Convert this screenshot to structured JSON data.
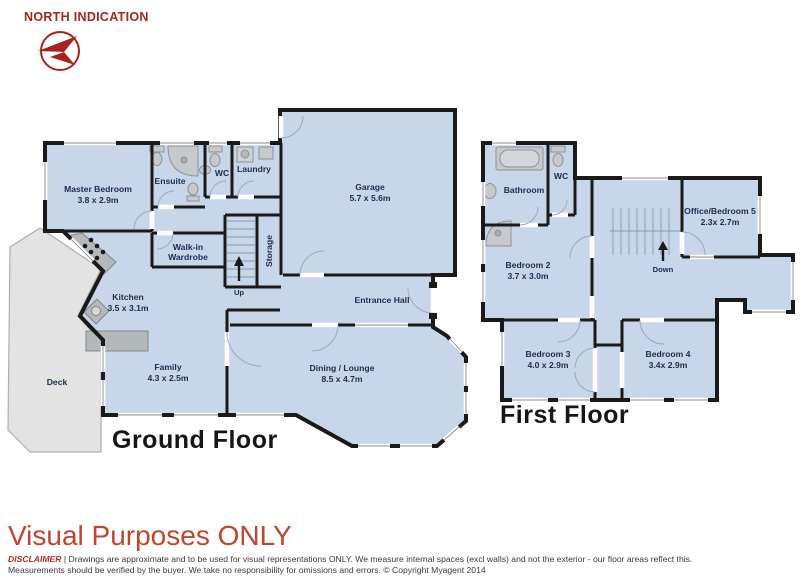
{
  "north": {
    "label": "NORTH INDICATION"
  },
  "floors": {
    "ground": {
      "title": "Ground Floor",
      "rooms": {
        "master": {
          "name": "Master Bedroom",
          "dims": "3.8 x 2.9m"
        },
        "ensuite": {
          "name": "Ensuite"
        },
        "wc": {
          "name": "WC"
        },
        "laundry": {
          "name": "Laundry"
        },
        "garage": {
          "name": "Garage",
          "dims": "5.7 x 5.6m"
        },
        "walkin": {
          "line1": "Walk-in",
          "line2": "Wardrobe"
        },
        "storage": {
          "name": "Storage"
        },
        "kitchen": {
          "name": "Kitchen",
          "dims": "3.5 x 3.1m"
        },
        "entrance": {
          "name": "Entrance Hall"
        },
        "deck": {
          "name": "Deck"
        },
        "family": {
          "name": "Family",
          "dims": "4.3 x 2.5m"
        },
        "dining": {
          "name": "Dining / Lounge",
          "dims": "8.5 x 4.7m"
        },
        "up": {
          "label": "Up"
        }
      }
    },
    "first": {
      "title": "First Floor",
      "rooms": {
        "bathroom": {
          "name": "Bathroom"
        },
        "wc": {
          "name": "WC"
        },
        "office": {
          "name": "Office/Bedroom 5",
          "dims": "2.3x 2.7m"
        },
        "bedroom2": {
          "name": "Bedroom 2",
          "dims": "3.7 x 3.0m"
        },
        "bedroom3": {
          "name": "Bedroom 3",
          "dims": "4.0 x 2.9m"
        },
        "bedroom4": {
          "name": "Bedroom 4",
          "dims": "3.4x 2.9m"
        },
        "down": {
          "label": "Down"
        }
      }
    }
  },
  "footer": {
    "headline": "Visual Purposes ONLY",
    "disclaimer_label": "DISCLAIMER",
    "line1": "| Drawings are approximate and to be used for visual representations ONLY. We measure internal spaces (excl walls) and not the exterior - our floor areas reflect this.",
    "line2": "Measurements should be verified by the buyer. We take no responsibility for omissions and errors. © Copyright Myagent 2014"
  },
  "colors": {
    "accent_red": "#a6241f",
    "headline_red": "#c2442f",
    "room_fill": "#c7d6e9",
    "wall": "#1a1a1a",
    "deck_fill": "#e3e3e3",
    "counter_fill": "#b5b8bb",
    "label_text": "#1c2c4e"
  }
}
